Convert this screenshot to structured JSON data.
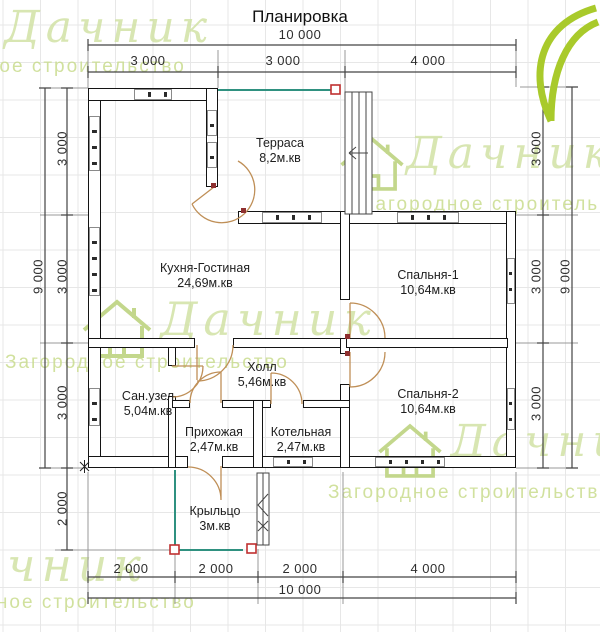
{
  "title": "Планировка",
  "dims": {
    "top_total": "10 000",
    "top_segments": [
      "3 000",
      "3 000",
      "4 000"
    ],
    "left_total": "9 000",
    "left_segments": [
      "3 000",
      "3 000",
      "3 000"
    ],
    "left_porch": "2 000",
    "right_segments": [
      "3 000",
      "3 000",
      "3 000"
    ],
    "right_total": "9 000",
    "bottom_segments": [
      "2 000",
      "2 000",
      "2 000",
      "4 000"
    ],
    "bottom_total": "10 000"
  },
  "rooms": {
    "terrace": {
      "name": "Терраса",
      "area": "8,2м.кв"
    },
    "kitchen_living": {
      "name": "Кухня-Гостиная",
      "area": "24,69м.кв"
    },
    "bedroom1": {
      "name": "Спальня-1",
      "area": "10,64м.кв"
    },
    "hall": {
      "name": "Холл",
      "area": "5,46м.кв"
    },
    "bedroom2": {
      "name": "Спальня-2",
      "area": "10,64м.кв"
    },
    "bathroom": {
      "name": "Сан.узел",
      "area": "5,04м.кв"
    },
    "hallway": {
      "name": "Прихожая",
      "area": "2,47м.кв"
    },
    "boiler": {
      "name": "Котельная",
      "area": "2,47м.кв"
    },
    "porch": {
      "name": "Крыльцо",
      "area": "3м.кв"
    }
  },
  "watermark": {
    "brand": "Дачник",
    "tagline": "Загородное строительство"
  },
  "colors": {
    "open_edge_teal": "#2f9180",
    "marker_red": "#c03030",
    "door_arc_tan": "#bf8f57",
    "logo_green": "#a9ca2b",
    "watermark_green": "#ccdf9a"
  }
}
